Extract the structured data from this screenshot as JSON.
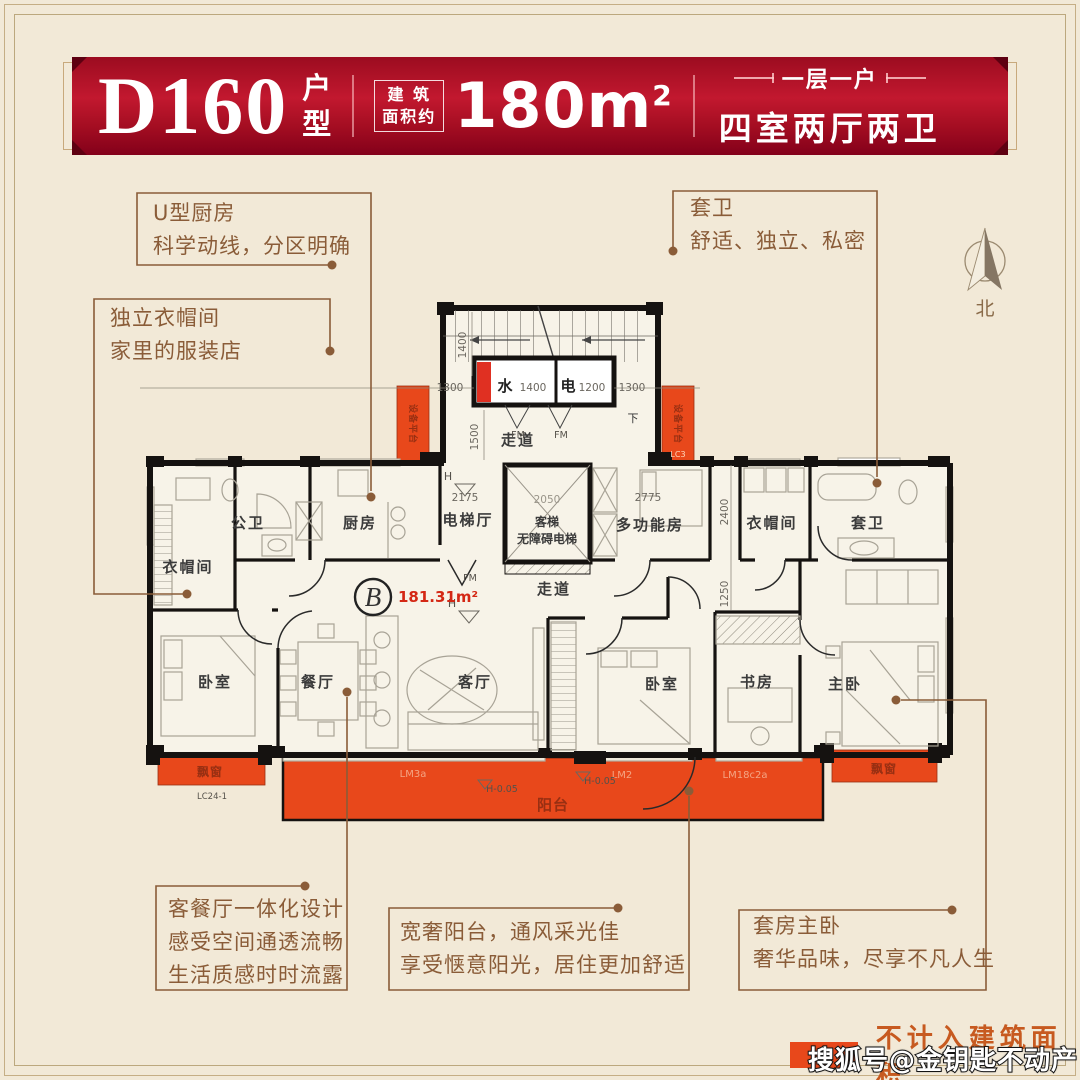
{
  "header": {
    "code": "D160",
    "code_suffix_1": "户",
    "code_suffix_2": "型",
    "area_label_1": "建 筑",
    "area_label_2": "面积约",
    "area_value": "180m",
    "area_exp": "2",
    "tagline_top": "一层一户",
    "tagline_main": "四室两厅两卫"
  },
  "callouts": {
    "kitchen": {
      "l1": "U型厨房",
      "l2": "科学动线，分区明确"
    },
    "cloak": {
      "l1": "独立衣帽间",
      "l2": "家里的服装店"
    },
    "suitebath": {
      "l1": "套卫",
      "l2": "舒适、独立、私密"
    },
    "livingdining": {
      "l1": "客餐厅一体化设计",
      "l2": "感受空间通透流畅",
      "l3": "生活质感时时流露"
    },
    "balcony": {
      "l1": "宽奢阳台，通风采光佳",
      "l2": "享受惬意阳光，居住更加舒适"
    },
    "master": {
      "l1": "套房主卧",
      "l2": "奢华品味，尽享不凡人生"
    }
  },
  "floorplan": {
    "rooms": {
      "cloak_left": "衣帽间",
      "pub_bath": "公卫",
      "kitchen": "厨房",
      "lift_hall": "电梯厅",
      "lift1": "客梯",
      "lift2": "无障碍电梯",
      "multi": "多功能房",
      "cloak_right": "衣帽间",
      "suite_bath": "套卫",
      "corridor_top": "走道",
      "corridor_mid": "走道",
      "bedroom_left": "卧室",
      "dining": "餐厅",
      "living": "客厅",
      "bedroom_mid": "卧室",
      "study": "书房",
      "master": "主卧",
      "balcony": "阳台",
      "bay_left": "飘窗",
      "bay_right": "飘窗",
      "equip_left": "设备平台",
      "equip_right": "设备平台",
      "water": "水",
      "elec": "电",
      "down": "下"
    },
    "dims": {
      "d1400": "1400",
      "d1300l": "1300",
      "d1300r": "1300",
      "d1500": "1500",
      "d2175": "2175",
      "d2050": "2050",
      "d2775": "2775",
      "d2400": "2400",
      "d1250": "1250",
      "w1400": "1400",
      "e1200": "1200"
    },
    "marks": {
      "fm1": "FM",
      "fm2": "FM",
      "fm3": "FM",
      "h1": "H",
      "h2": "H",
      "lm3a": "LM3a",
      "lm2": "LM2",
      "lm18": "LM18c2a",
      "h005a": "H-0.05",
      "h005b": "H-0.05",
      "lc3": "LC3",
      "lc24": "LC24-1",
      "unit": "B",
      "area": "181.31m²"
    }
  },
  "compass": {
    "label": "北"
  },
  "legend": {
    "label": "不计入建筑面积",
    "color": "#e8481b"
  },
  "watermark": "搜狐号@金钥匙不动产"
}
